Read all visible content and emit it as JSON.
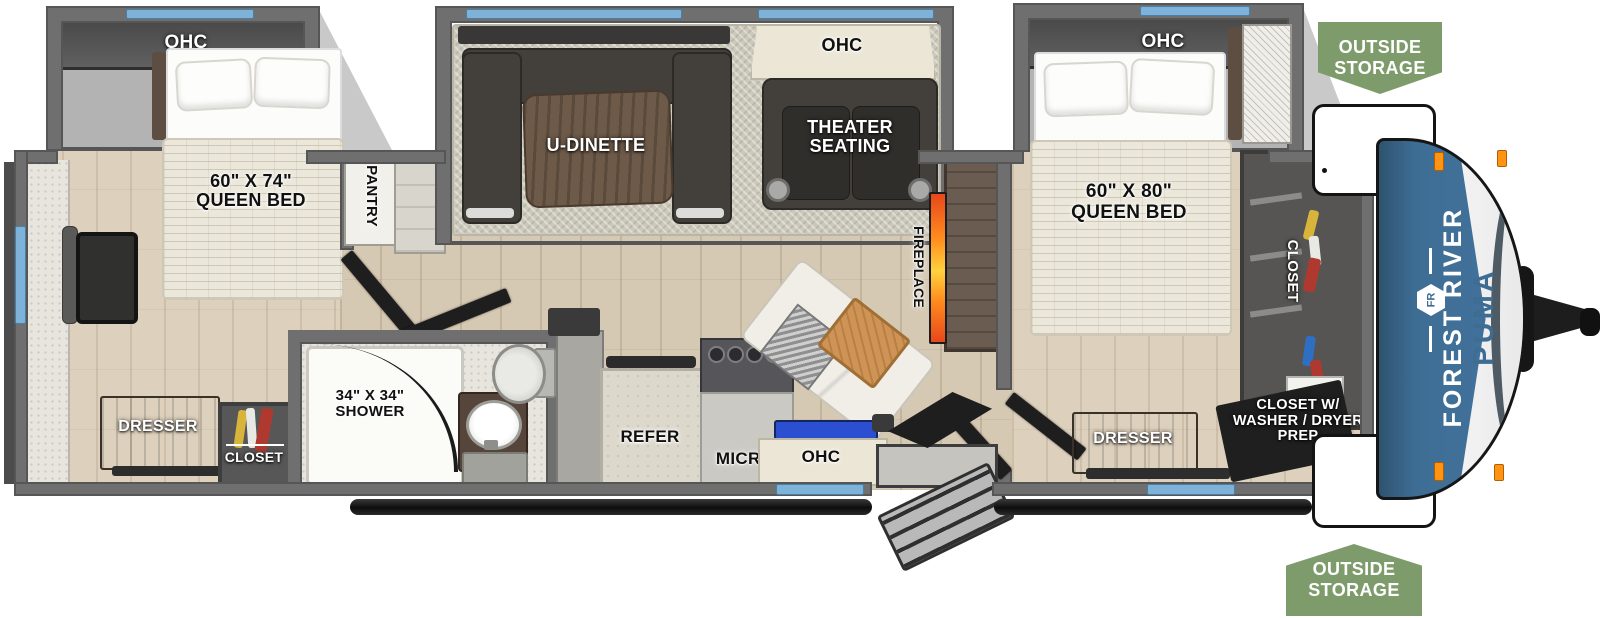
{
  "badges": {
    "outside_storage_top": "OUTSIDE\nSTORAGE",
    "outside_storage_bottom": "OUTSIDE\nSTORAGE"
  },
  "front_cap": {
    "brand": "FOREST RIVER",
    "logo": "FR",
    "model": "PUMA"
  },
  "rear_bedroom": {
    "ohc": "OHC",
    "bed": "60\" X 74\"\nQUEEN BED",
    "dresser": "DRESSER",
    "closet": "CLOSET",
    "pantry": "PANTRY"
  },
  "bathroom": {
    "shower": "34\" X 34\"\nSHOWER"
  },
  "living_area": {
    "dinette": "U-DINETTE",
    "theater_ohc": "OHC",
    "theater": "THEATER\nSEATING",
    "fireplace": "FIREPLACE"
  },
  "kitchen": {
    "refer": "REFER",
    "micro": "MICRO",
    "ohc": "OHC"
  },
  "front_bedroom": {
    "ohc": "OHC",
    "bed": "60\" X 80\"\nQUEEN BED",
    "closet": "CLOSET",
    "dresser": "DRESSER",
    "washer_closet": "CLOSET W/\nWASHER / DRYER\nPREP"
  },
  "colors": {
    "wall": "#6f6f6f",
    "window_blue": "#7fb2d9",
    "cap_blue": "#3e6d94",
    "badge_green": "#7e9c6b",
    "flame_orange": "#f26a1b",
    "counter_blue": "#2b4fd0"
  }
}
